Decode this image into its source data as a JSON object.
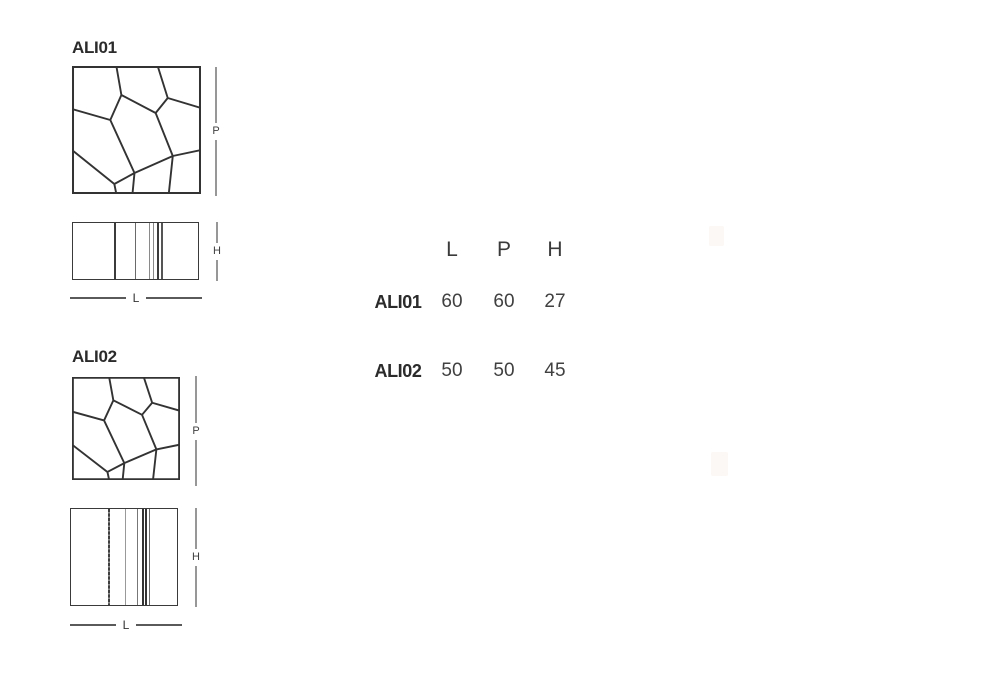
{
  "page": {
    "background": "#ffffff"
  },
  "products": [
    {
      "id": "ALI01",
      "label": "ALI01",
      "dims": {
        "depth": "P",
        "height": "H",
        "length": "L"
      }
    },
    {
      "id": "ALI02",
      "label": "ALI02",
      "dims": {
        "depth": "P",
        "height": "H",
        "length": "L"
      }
    }
  ],
  "table": {
    "headers": [
      "L",
      "P",
      "H"
    ],
    "rows": [
      {
        "label": "ALI01",
        "values": [
          "60",
          "60",
          "27"
        ]
      },
      {
        "label": "ALI02",
        "values": [
          "50",
          "50",
          "45"
        ]
      }
    ]
  },
  "colors": {
    "drawing_stroke": "#3a3a3a",
    "dimension_line": "#979797",
    "text_dark": "#2b2b2b",
    "text_gray": "#404040"
  }
}
